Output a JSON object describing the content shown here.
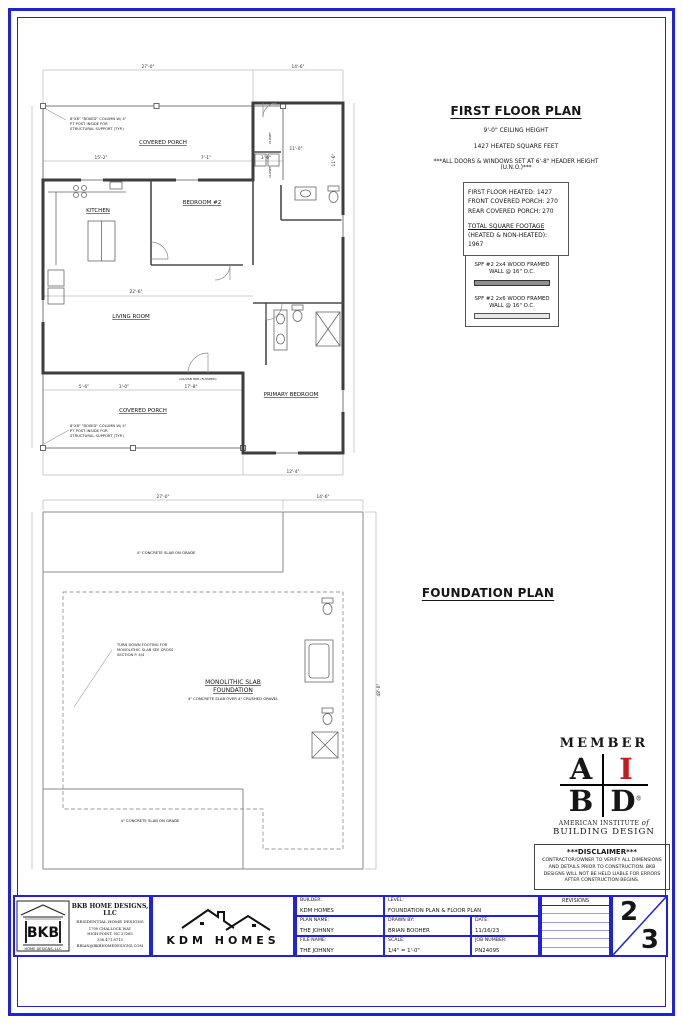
{
  "colors": {
    "frame_blue": "#2121d6",
    "accent_red": "#c21d1d"
  },
  "floor_plan": {
    "title": "FIRST FLOOR PLAN",
    "ceiling_height": "9'-0\" CEILING HEIGHT",
    "heated_sqft": "1427 HEATED SQUARE FEET",
    "header_note": "***ALL DOORS & WINDOWS SET AT 6'-8\" HEADER HEIGHT (U.N.O.)***",
    "sqft_box": {
      "heated": "FIRST FLOOR HEATED: 1427",
      "front_porch": "FRONT COVERED PORCH: 270",
      "rear_porch": "REAR COVERED PORCH: 270",
      "total_label": "TOTAL SQUARE FOOTAGE",
      "total_value": "(HEATED & NON-HEATED): 1967"
    },
    "wall_legend": {
      "wall_2x4": "SPF #2 2x4 WOOD FRAMED WALL @ 16\" O.C.",
      "wall_2x6": "SPF #2 2x6 WOOD FRAMED WALL @ 16\" O.C."
    },
    "rooms": {
      "covered_porch_front": "COVERED PORCH",
      "kitchen": "KITCHEN",
      "bedroom_2": "BEDROOM #2",
      "living_room": "LIVING ROOM",
      "primary_bedroom": "PRIMARY BEDROOM",
      "covered_porch_rear": "COVERED PORCH",
      "closet": "CLOSET"
    },
    "notes": {
      "boxed_column_front": "8\"X8\" \"BOXED\" COLUMN W/ 4\" PT POST INSIDE FOR STRUCTURAL SUPPORT (TYP.)",
      "boxed_column_rear": "8\"X8\" \"BOXED\" COLUMN W/ 4\" PT POST INSIDE FOR STRUCTURAL SUPPORT (TYP.)",
      "flush_header": "LVL/OSB HDR (FLUSHED)"
    },
    "dims": {
      "overall_width": "27'-0\"",
      "wing_width": "14'-6\"",
      "porch_a": "15'-2\"",
      "porch_b": "7'-1\"",
      "porch_c": "3'-6\"",
      "living_width": "22'-6\"",
      "rear_a": "5'-6\"",
      "rear_b": "3'-0\"",
      "rear_c": "17'-8\"",
      "primary_width": "12'-4\"",
      "bed_width": "11'-0\"",
      "bed_depth": "11'-6\""
    }
  },
  "foundation_plan": {
    "title": "FOUNDATION PLAN",
    "slab_title_1": "MONOLITHIC SLAB",
    "slab_title_2": "FOUNDATION",
    "slab_sub": "4\" CONCRETE SLAB OVER 4\" CRUSHED GRAVEL",
    "slab_on_grade_front": "4\" CONCRETE SLAB ON GRADE",
    "slab_on_grade_rear": "4\" CONCRETE SLAB ON GRADE",
    "turndown_note": "TURN DOWN FOOTING FOR MONOLITHIC SLAB SEE CROSS SECTION P. 4/4",
    "dims": {
      "overall_width": "27'-0\"",
      "wing_width": "14'-6\"",
      "overall_depth": "48'-0\""
    }
  },
  "member_badge": {
    "member": "MEMBER",
    "letter_a": "A",
    "letter_i": "I",
    "letter_b": "B",
    "letter_d": "D",
    "registered": "®",
    "line1": "AMERICAN INSTITUTE",
    "of": "of",
    "line2": "BUILDING DESIGN"
  },
  "disclaimer": {
    "title": "***DISCLAIMER***",
    "body": "CONTRACTOR/OWNER TO VERIFY ALL DIMENSIONS AND DETAILS PRIOR TO CONSTRUCTION. BKB DESIGNS WILL NOT BE HELD LIABLE FOR ERRORS AFTER CONSTRUCTION BEGINS."
  },
  "title_block": {
    "bkb": {
      "logo": "BKB",
      "logo_sub": "HOME DESIGNS, LLC",
      "name": "BKB HOME DESIGNS, LLC",
      "tagline": "RESIDENTIAL HOME DESIGNS",
      "address1": "1700 CHALLOCK WAY",
      "address2": "HIGH POINT, NC 27265",
      "address3": "336.471.8713",
      "address4": "BRIAN@BKBHOMEDESIGNS.COM"
    },
    "kdm": {
      "name": "KDM HOMES"
    },
    "fields": {
      "builder_label": "BUILDER:",
      "builder_value": "KDM HOMES",
      "level_label": "LEVEL:",
      "level_value": "FOUNDATION PLAN & FLOOR PLAN",
      "plan_label": "PLAN NAME:",
      "plan_value": "THE JOHNNY",
      "drawn_label": "DRAWN BY:",
      "drawn_value": "BRIAN BOOHER",
      "date_label": "DATE:",
      "date_value": "11/16/23",
      "file_label": "FILE NAME:",
      "file_value": "THE JOHNNY",
      "scale_label": "SCALE:",
      "scale_value": "1/4\" = 1'-0\"",
      "job_label": "JOB NUMBER:",
      "job_value": "PN24095"
    },
    "revisions_label": "REVISIONS",
    "sheet_number": {
      "current": "2",
      "total": "3"
    }
  }
}
